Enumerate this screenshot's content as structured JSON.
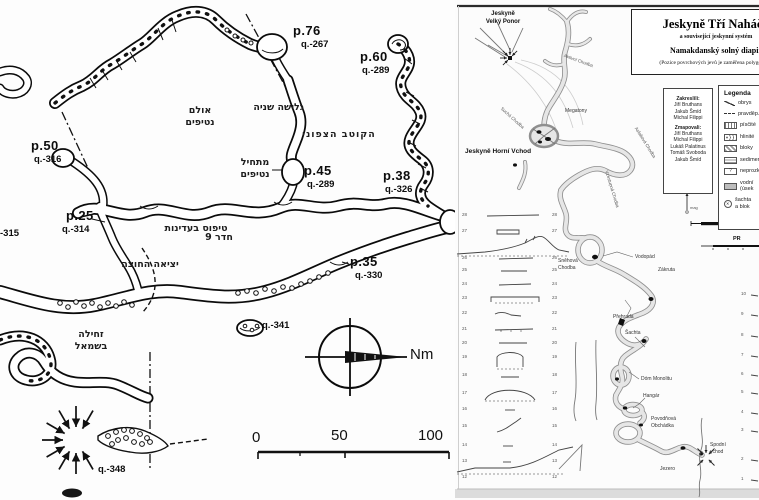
{
  "left_map": {
    "stations": [
      {
        "id": "p76",
        "p": "p.76",
        "q": "q.-267"
      },
      {
        "id": "p60",
        "p": "p.60",
        "q": "q.-289"
      },
      {
        "id": "p50",
        "p": "p.50",
        "q": "q.-316"
      },
      {
        "id": "p45",
        "p": "p.45",
        "q": "q.-289"
      },
      {
        "id": "p38",
        "p": "p.38",
        "q": "q.-326"
      },
      {
        "id": "p25",
        "p": "p.25",
        "q": "q.-314"
      },
      {
        "id": "p35",
        "p": "p.35",
        "q": "q.-330"
      }
    ],
    "depth_labels": {
      "q341": "q.-341",
      "q348": "q.-348",
      "q315_clipped": "-315"
    },
    "hebrew_labels": {
      "stalactite_hall_1": "אולם",
      "stalactite_hall_2": "נטיפים",
      "second_slide": "גלישה שניה",
      "north_pole": "הקוטב הצפוני",
      "stalactites_start_1": "מתחיל",
      "stalactites_start_2": "נטיפים",
      "climb_gently": "טיפוס בעדינות",
      "room_9": "חדר 9",
      "exit_outside": "יציאה החוצה",
      "crawl_left_1": "זחילה",
      "crawl_left_2": "בשמאל"
    },
    "compass_label": "Nm",
    "scale_ticks": [
      "0",
      "50",
      "100"
    ]
  },
  "right_map": {
    "title_block": {
      "title": "Jeskyně Tří Naháčů",
      "subtitle": "a související jeskynní systém",
      "line2": "Namakdanský solný diapir",
      "line3": "(Pozice povrchových jevů je zaměřena polygonem)"
    },
    "credits": {
      "heading1": "Zakreslili:",
      "names1": [
        "Jiří Bruthans",
        "Jakub Šmíd",
        "Michal Filippi"
      ],
      "heading2": "Zmapovali:",
      "names2": [
        "Jiří Bruthans",
        "Michal Filippi",
        "Lukáš Palatinus",
        "Tomáš Svoboda",
        "Jakub Šmíd"
      ]
    },
    "legend": {
      "title": "Legenda",
      "items": [
        {
          "sym": "sym-zig",
          "t1": "obrys",
          "t2": ""
        },
        {
          "sym": "sym-dash",
          "t1": "pravděp.",
          "t2": ""
        },
        {
          "sym": "sym-dot",
          "t1": "písčité",
          "t2": ""
        },
        {
          "sym": "sym-pebl",
          "t1": "hlinité",
          "t2": ""
        },
        {
          "sym": "sym-brick",
          "t1": "bloky",
          "t2": ""
        },
        {
          "sym": "sym-sed",
          "t1": "sedimen.",
          "t2": ""
        },
        {
          "sym": "sym-q",
          "t1": "neprozk.",
          "t2": ""
        },
        {
          "sym": "sym-fill",
          "t1": "vodní",
          "t2": "(úsek"
        },
        {
          "sym": "sym-shaft",
          "t1": "šachta",
          "t2": "a blok"
        }
      ]
    },
    "scalebars": {
      "map_label": "M",
      "profile_label": "PR"
    },
    "north_label": "mag",
    "place_labels": [
      {
        "id": "velky-ponor",
        "line1": "Jeskyně",
        "line2": "Velký Ponor"
      },
      {
        "id": "aktivni-chodba",
        "text": "Aktivní Chodba"
      },
      {
        "id": "megatony",
        "text": "Megatony"
      },
      {
        "id": "horni-vchod",
        "text": "Jeskyně Horní Vchod"
      },
      {
        "id": "sucha-chodba",
        "text": "Suchá Chodba"
      },
      {
        "id": "vzestupna-chodba",
        "text": "Vzestupná Chodba"
      },
      {
        "id": "asfaltova-chodba",
        "text": "Asfaltová Chodba"
      },
      {
        "id": "snehova-chodba",
        "line1": "Sněhová",
        "line2": "Chodba"
      },
      {
        "id": "vodopad",
        "text": "Vodopád"
      },
      {
        "id": "zakruta",
        "text": "Zákruta"
      },
      {
        "id": "prehrada",
        "text": "Přehrada"
      },
      {
        "id": "sachta",
        "text": "Šachta"
      },
      {
        "id": "dom-monolitu",
        "text": "Dóm Monolitu"
      },
      {
        "id": "hangar",
        "text": "Hangár"
      },
      {
        "id": "povodnova-obchadka",
        "line1": "Povodňová",
        "line2": "Obchádka"
      },
      {
        "id": "jezero",
        "text": "Jezero"
      },
      {
        "id": "spodni-vchod",
        "line1": "Spodní",
        "line2": "vchod"
      }
    ],
    "sections_left": [
      {
        "n": "28",
        "y": 216
      },
      {
        "n": "27",
        "y": 232
      },
      {
        "n": "26",
        "y": 259
      },
      {
        "n": "25",
        "y": 271
      },
      {
        "n": "24",
        "y": 285
      },
      {
        "n": "23",
        "y": 299
      },
      {
        "n": "22",
        "y": 314
      },
      {
        "n": "21",
        "y": 330
      },
      {
        "n": "20",
        "y": 344
      },
      {
        "n": "19",
        "y": 358
      },
      {
        "n": "18",
        "y": 376
      },
      {
        "n": "17",
        "y": 394
      },
      {
        "n": "16",
        "y": 410
      },
      {
        "n": "15",
        "y": 427
      },
      {
        "n": "14",
        "y": 446
      },
      {
        "n": "13",
        "y": 462
      },
      {
        "n": "12",
        "y": 478
      }
    ],
    "sections_right": [
      {
        "n": "10",
        "y": 295
      },
      {
        "n": "9",
        "y": 315
      },
      {
        "n": "8",
        "y": 336
      },
      {
        "n": "7",
        "y": 356
      },
      {
        "n": "6",
        "y": 375
      },
      {
        "n": "5",
        "y": 393
      },
      {
        "n": "4",
        "y": 413
      },
      {
        "n": "3",
        "y": 431
      },
      {
        "n": "2",
        "y": 460
      },
      {
        "n": "1",
        "y": 480
      }
    ]
  }
}
